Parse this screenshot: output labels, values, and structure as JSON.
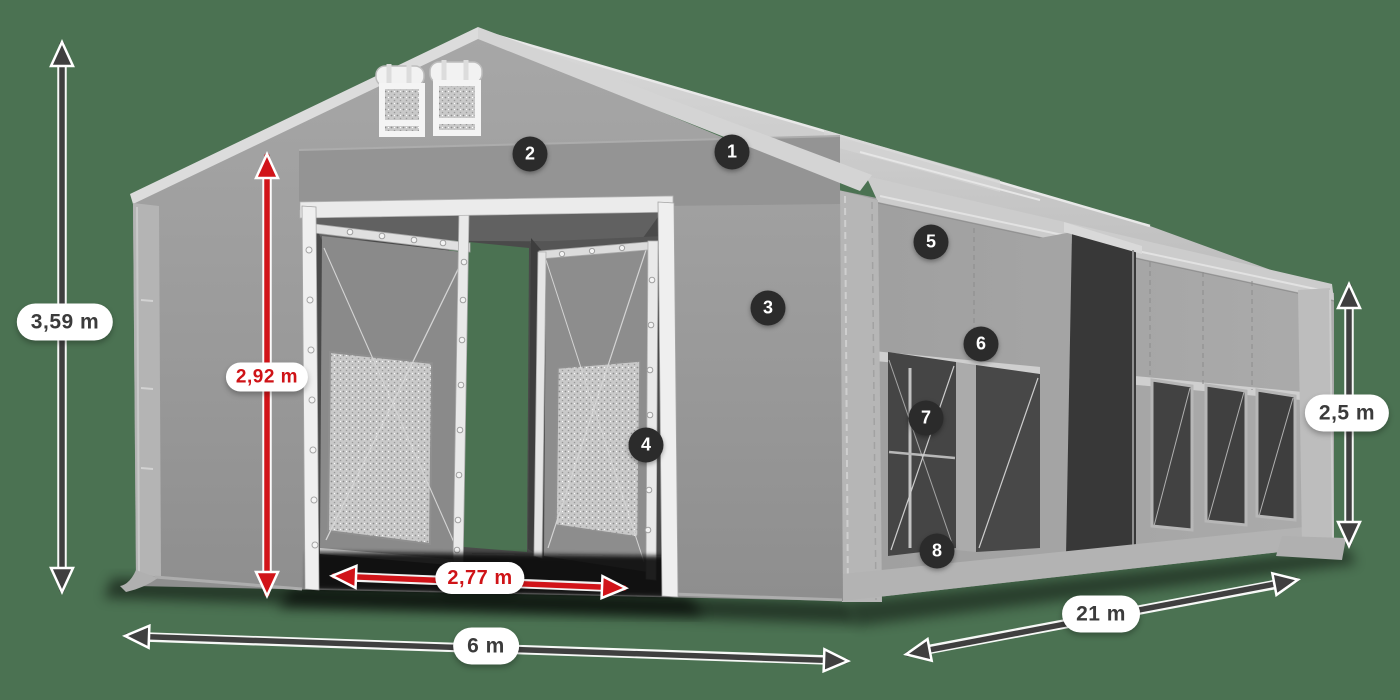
{
  "colors": {
    "background": "#4b7252",
    "red_accent": "#d11419",
    "dark_arrow": "#3f3f3f",
    "tent_fabric": "#9d9d9d",
    "badge_background": "#2b2b2b"
  },
  "dimensions": {
    "total_height": "3,59 m",
    "door_height": "2,92 m",
    "door_width": "2,77 m",
    "front_width": "6 m",
    "length": "21 m",
    "side_height": "2,5 m"
  },
  "badges": [
    "1",
    "2",
    "3",
    "4",
    "5",
    "6",
    "7",
    "8"
  ]
}
